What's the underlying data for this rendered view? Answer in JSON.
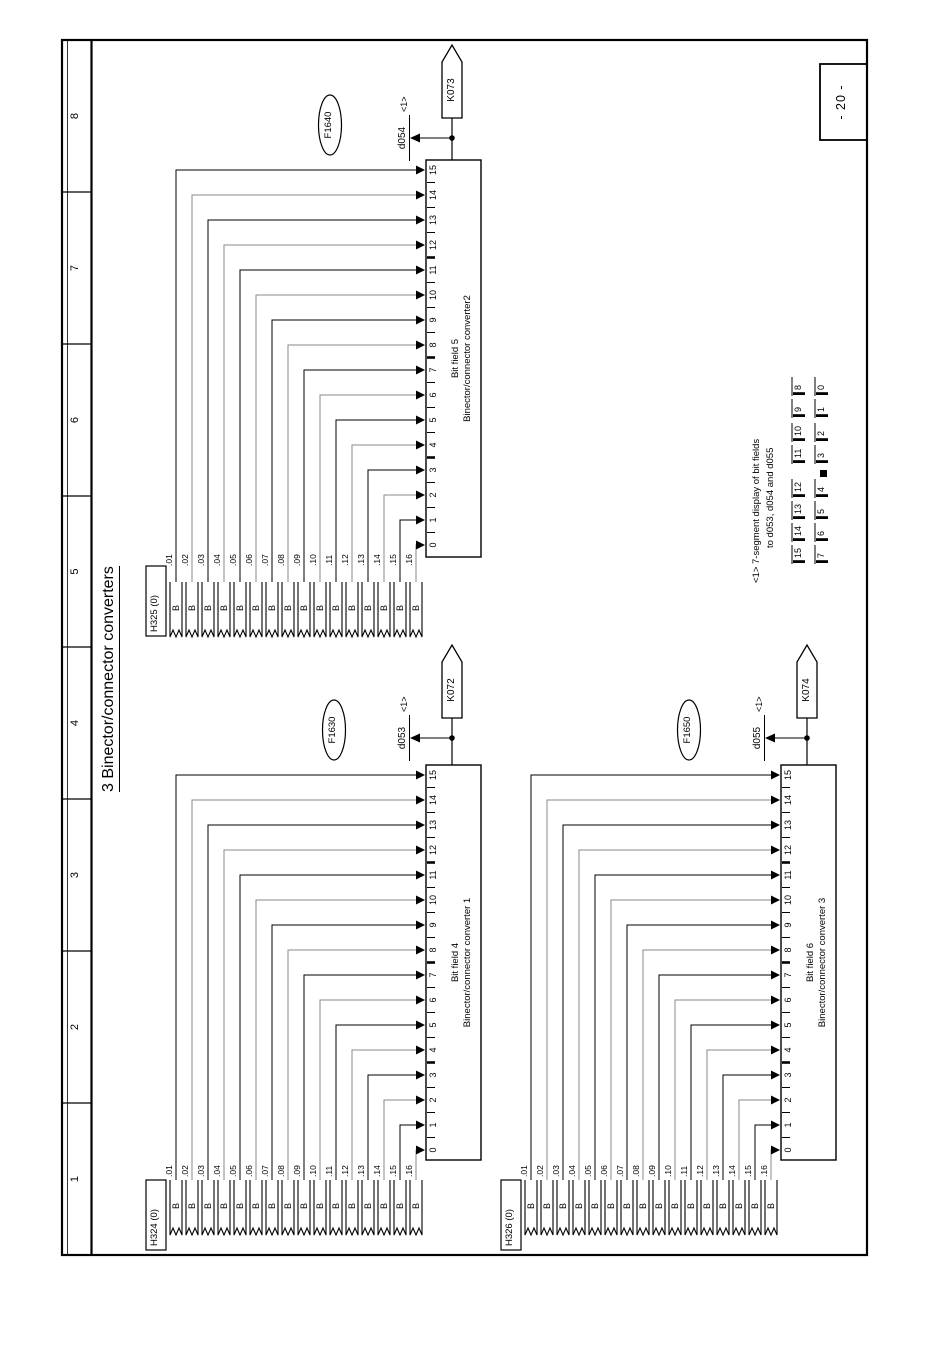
{
  "page": {
    "title": "3 Binector/connector converters",
    "page_number": "- 20 -",
    "column_numbers": [
      "1",
      "2",
      "3",
      "4",
      "5",
      "6",
      "7",
      "8"
    ]
  },
  "note": {
    "line1": "<1> 7-segment display of bit fields",
    "line2": "to d053, d054 and d055",
    "seg_high": [
      "15",
      "14",
      "13",
      "12",
      "11",
      "10",
      "9",
      "8"
    ],
    "seg_low": [
      "7",
      "6",
      "5",
      "4",
      "3",
      "2",
      "1",
      "0"
    ]
  },
  "converters": [
    {
      "source_param": "H324 (0)",
      "binector_label": "B",
      "bits": [
        ".01",
        ".02",
        ".03",
        ".04",
        ".05",
        ".06",
        ".07",
        ".08",
        ".09",
        ".10",
        ".11",
        ".12",
        ".13",
        ".14",
        ".15",
        ".16"
      ],
      "pins": [
        "15",
        "14",
        "13",
        "12",
        "11",
        "10",
        "9",
        "8",
        "7",
        "6",
        "5",
        "4",
        "3",
        "2",
        "1",
        "0"
      ],
      "block_title": "Bit field 4",
      "block_subtitle": "Binector/connector converter 1",
      "fault_ref": "F1630",
      "display_param": "d053",
      "ref_mark": "<1>",
      "output_connector": "K072"
    },
    {
      "source_param": "H325 (0)",
      "binector_label": "B",
      "bits": [
        ".01",
        ".02",
        ".03",
        ".04",
        ".05",
        ".06",
        ".07",
        ".08",
        ".09",
        ".10",
        ".11",
        ".12",
        ".13",
        ".14",
        ".15",
        ".16"
      ],
      "pins": [
        "15",
        "14",
        "13",
        "12",
        "11",
        "10",
        "9",
        "8",
        "7",
        "6",
        "5",
        "4",
        "3",
        "2",
        "1",
        "0"
      ],
      "block_title": "Bit field 5",
      "block_subtitle": "Binector/connector converter2",
      "fault_ref": "F1640",
      "display_param": "d054",
      "ref_mark": "<1>",
      "output_connector": "K073"
    },
    {
      "source_param": "H326 (0)",
      "binector_label": "B",
      "bits": [
        ".01",
        ".02",
        ".03",
        ".04",
        ".05",
        ".06",
        ".07",
        ".08",
        ".09",
        ".10",
        ".11",
        ".12",
        ".13",
        ".14",
        ".15",
        ".16"
      ],
      "pins": [
        "15",
        "14",
        "13",
        "12",
        "11",
        "10",
        "9",
        "8",
        "7",
        "6",
        "5",
        "4",
        "3",
        "2",
        "1",
        "0"
      ],
      "block_title": "Bit field 6",
      "block_subtitle": "Binector/connector converter 3",
      "fault_ref": "F1650",
      "display_param": "d055",
      "ref_mark": "<1>",
      "output_connector": "K074"
    }
  ]
}
